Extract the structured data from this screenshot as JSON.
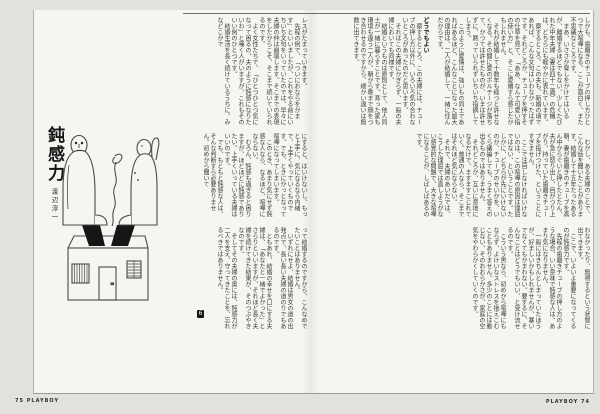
{
  "publication": {
    "brand": "PLAYBOY",
    "footer_left_number": "75",
    "footer_right_number": "74"
  },
  "article": {
    "title": "鈍感力",
    "author": "渡辺淳一",
    "subhead": "どうでもよい",
    "end_mark": "6"
  },
  "illustration": {
    "name": "two-figures-seated-on-open-house-with-smoke-squiggle"
  },
  "text": {
    "right_band1_pre": "しかも、歯磨きのチューブの押し方ひとつで大喧嘩になる。ここが面白く、また不思議なところです。\n　まあ、いささか脅しをかけてはいるが、離婚するほどでもない、少しくたびれた中年夫婦（妻は四十二歳）の危機は、どちらにも軽やかに表れています。\n　察するところ、この夫も、新婚の頃であれば、こんな文句はいわなかったはずです。それどころか、チューブを押すその仕草を見て、「ああ、なんて可愛い指の使い方」と、そこに愛嬌すら感じたかもしれません。\n　それが結婚して十数年も経つと許せなくなる。その間に愛のボルテージが落ちて、かつては許せたものが、いまは許せずに、黙っていられずいちいち指摘してしまう。\n　このように愛情は、強いもの同士であればあるほど、こんなことになった最大の理由は、二人が結婚して、一緒に住んだからです。\n",
    "right_band1_post": "　察するところ、この夫婦には、チューブの押し方以外に、いろいろ気の合わないところがあったのだと思います。\n　それはこの夫婦にかぎらず、一般の夫婦においても同様です。\n　結婚というものは原則として、他人同士が一緒に暮らすことです。育った家も環境も違う二人が、朝から晩まで顔をつき合わせるのですから、細かい違いは無数に出てきます。",
    "right_band2": "　むかし、ある夫婦のことで、こんな話を聞いたことがあります。結婚して十五年たったある朝、妻が歯磨きのチューブを真ん中からぐいと押したとたん、夫が急に怒り出し、目がつり上がり、持っていた歯磨きチューブを投げつけた、ということにすぎません。\n　ここで注目しなければいけないのは、この喧嘩の原因は理屈ではない、ということです。たしかに、どちらが先にいけないのか、チューブのせいかを、いくら議論しても、うまく答えの出るものではありません。\n　それどころか、互いに意地になるだけで、ますますこじれていく。普通の人なら、そこまではそれほど気にならない。\n　それで、夫婦のあいだでは、こうした理屈では直しようがない感覚的な問題で、大きな喧嘩になることが、しばしばあるのです。",
    "right_band3": "わなかったり、無視するという状態に出てきます。\n　ここで、いよいよ重要になってくるのが鈍感力です。\n　先程の歯磨きチューブの押し方のような場合、いい意味で鈍感な人は、あまり気になりません。\n　一般にはきちんとしまっていたほうが、好ましいかもしれませんが、塞いでなくてもかまわない。要するに、そんなことはどうでもいい、と受け流せるのです。\n　こういう男なら、初めから喧嘩にもならず、よけいなストレスを抱えこむこともありません。多少のことには動じない、そのおおらかさが、家庭の空気をやわらかくしていくのです。",
    "left_band1": "レスがたまっていきます。\n　先程の例で、「ついにおならをかます」といいましたが、これをやる前にいちいち文句をいっていたのでは、早々に夫婦の仲は崩壊します。そこまでの表現をしたからこそ、そこまで続いていられるのです。\n　よく女性たちで、「ひとつひとつ気になって困るの、夫のように鈍感になりたいわ」と嘆く人がいますが、これもそのいい例のひとつです。\n　結婚生活を長く続けているうちに、みなどこかで",
    "left_band2": "にすると、はいけないし、もっと上手に、気になるなら内緒で、上手くやっていくものです。でも、ときにかっとなって喧嘩になってしまいます。\n　このとき、あまり気にせず鈍感な人なら、なるほど、喧嘩にならない。\n　むろん、鈍感も過ぎると困りますが、ほどほどに鈍感でありたい。上手くいっている夫婦はいいのです。\n　でも、もともと鈍感な人は、そんな判断すら必要ありません。初めから聞いて",
    "left_band3": "って結婚するのですから、こんなめでたいことはありません。\n　いずれにせよ、結婚は男女の道の出発点で、長い長い夫婦の道のりでもあるのです。\n　ともあれ、結婚の幸せを口にする夫婦は、「あなたと一緒でよかった」とさらりといいますが、それほど長く夫婦を続けてきた結果が、そのつぶやきなのです。\n　そしてその夫婦の奥には、鈍感力が二人を支え、守ってきたことを、忘れるべきではありません。"
  }
}
